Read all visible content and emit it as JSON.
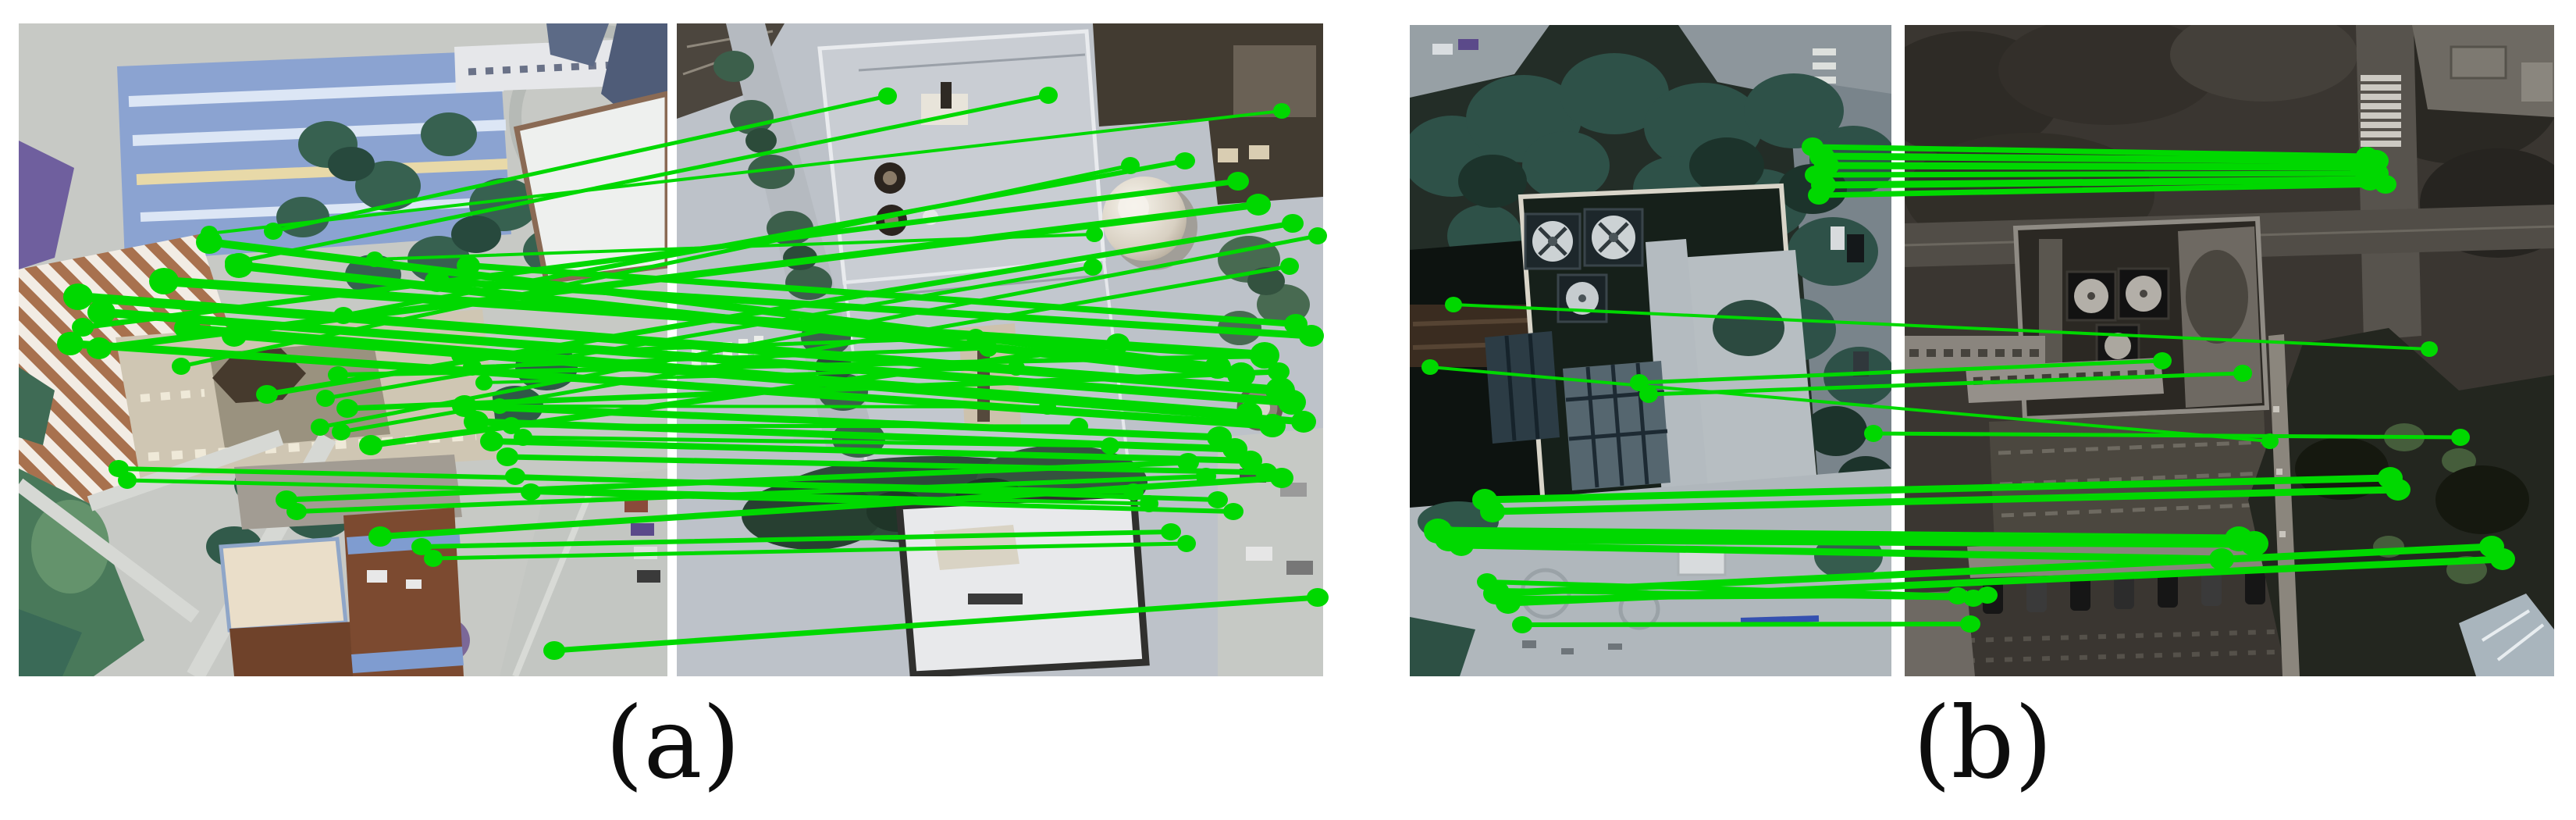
{
  "figure": {
    "match_color": "#00d800",
    "panels": [
      {
        "id": "a",
        "caption": "(a)",
        "matches": [
          [
            350,
            296,
            1137,
            123,
            5
          ],
          [
            300,
            336,
            1343,
            122,
            5
          ],
          [
            268,
            299,
            1642,
            142,
            4
          ],
          [
            440,
            404,
            1518,
            206,
            6
          ],
          [
            106,
            419,
            1586,
            232,
            7
          ],
          [
            127,
            446,
            1612,
            262,
            9
          ],
          [
            232,
            469,
            1448,
            212,
            5
          ],
          [
            342,
            505,
            1656,
            286,
            7
          ],
          [
            480,
            332,
            1402,
            300,
            4
          ],
          [
            268,
            310,
            1560,
            470,
            10
          ],
          [
            306,
            340,
            1590,
            480,
            11
          ],
          [
            210,
            360,
            1620,
            455,
            12
          ],
          [
            100,
            380,
            1640,
            500,
            12
          ],
          [
            130,
            400,
            1655,
            515,
            11
          ],
          [
            240,
            420,
            1600,
            530,
            10
          ],
          [
            90,
            440,
            1630,
            545,
            10
          ],
          [
            300,
            430,
            1670,
            540,
            9
          ],
          [
            560,
            360,
            1680,
            430,
            9
          ],
          [
            600,
            340,
            1660,
            415,
            8
          ],
          [
            433,
            480,
            1622,
            456,
            6
          ],
          [
            445,
            523,
            1638,
            476,
            7
          ],
          [
            417,
            510,
            1400,
            342,
            5
          ],
          [
            410,
            547,
            1688,
            302,
            5
          ],
          [
            437,
            553,
            1652,
            341,
            5
          ],
          [
            475,
            570,
            1432,
            440,
            8
          ],
          [
            590,
            455,
            1250,
            432,
            5
          ],
          [
            605,
            470,
            1266,
            446,
            5
          ],
          [
            620,
            490,
            1302,
            471,
            4
          ],
          [
            640,
            520,
            1342,
            521,
            4
          ],
          [
            655,
            545,
            1382,
            546,
            5
          ],
          [
            670,
            560,
            1422,
            571,
            5
          ],
          [
            595,
            520,
            1562,
            560,
            9
          ],
          [
            610,
            540,
            1582,
            575,
            9
          ],
          [
            630,
            565,
            1602,
            590,
            8
          ],
          [
            650,
            585,
            1622,
            605,
            7
          ],
          [
            367,
            640,
            1522,
            592,
            7
          ],
          [
            380,
            655,
            1545,
            610,
            6
          ],
          [
            152,
            600,
            1452,
            630,
            6
          ],
          [
            163,
            615,
            1472,
            645,
            5
          ],
          [
            660,
            610,
            1560,
            640,
            6
          ],
          [
            680,
            630,
            1580,
            655,
            6
          ],
          [
            540,
            700,
            1500,
            681,
            6
          ],
          [
            555,
            715,
            1520,
            696,
            5
          ],
          [
            487,
            687,
            1642,
            612,
            8
          ],
          [
            710,
            833,
            1688,
            765,
            7
          ]
        ]
      },
      {
        "id": "b",
        "caption": "(b)",
        "matches": [
          [
            2322,
            188,
            3032,
            200,
            7
          ],
          [
            2334,
            200,
            3044,
            206,
            9
          ],
          [
            2340,
            212,
            3026,
            214,
            9
          ],
          [
            2326,
            224,
            3046,
            222,
            7
          ],
          [
            2336,
            237,
            3036,
            230,
            9
          ],
          [
            2330,
            250,
            3056,
            236,
            7
          ],
          [
            1862,
            390,
            3112,
            447,
            4
          ],
          [
            1832,
            470,
            2908,
            565,
            4
          ],
          [
            2100,
            490,
            2770,
            462,
            5
          ],
          [
            2112,
            505,
            2873,
            478,
            5
          ],
          [
            2400,
            555,
            3152,
            560,
            5
          ],
          [
            1902,
            640,
            3062,
            612,
            9
          ],
          [
            1912,
            655,
            3072,
            627,
            9
          ],
          [
            1842,
            680,
            2868,
            690,
            11
          ],
          [
            1856,
            690,
            2888,
            696,
            11
          ],
          [
            1872,
            698,
            2846,
            716,
            9
          ],
          [
            1905,
            745,
            2508,
            763,
            6
          ],
          [
            1920,
            756,
            2528,
            766,
            6
          ],
          [
            1936,
            766,
            2546,
            762,
            6
          ],
          [
            1950,
            800,
            2524,
            799,
            6
          ],
          [
            1916,
            760,
            3192,
            700,
            9
          ],
          [
            1932,
            772,
            3206,
            716,
            9
          ]
        ]
      }
    ]
  }
}
